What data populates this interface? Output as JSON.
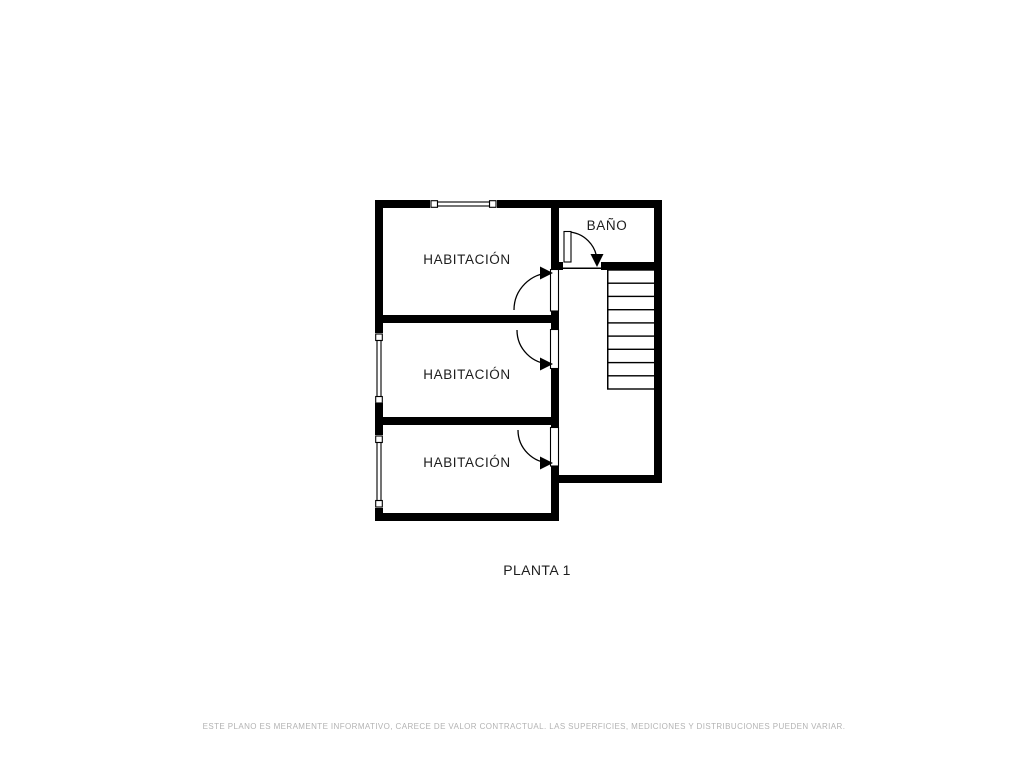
{
  "title": "PLANTA 1",
  "rooms": [
    {
      "name": "habitacion-top",
      "label": "HABITACIÓN"
    },
    {
      "name": "habitacion-middle",
      "label": "HABITACIÓN"
    },
    {
      "name": "habitacion-bottom",
      "label": "HABITACIÓN"
    },
    {
      "name": "bano",
      "label": "BAÑO"
    }
  ],
  "stairs": {
    "treads": 9
  },
  "icons": [
    "door-icon",
    "window-icon",
    "stairs-icon"
  ],
  "disclaimer": "ESTE PLANO ES MERAMENTE INFORMATIVO, CARECE DE VALOR CONTRACTUAL. LAS SUPERFICIES, MEDICIONES Y DISTRIBUCIONES PUEDEN VARIAR.",
  "colors": {
    "walls": "#000000",
    "labels": "#1d1d1d",
    "disclaimer": "#b3b3b3",
    "background": "#ffffff"
  }
}
